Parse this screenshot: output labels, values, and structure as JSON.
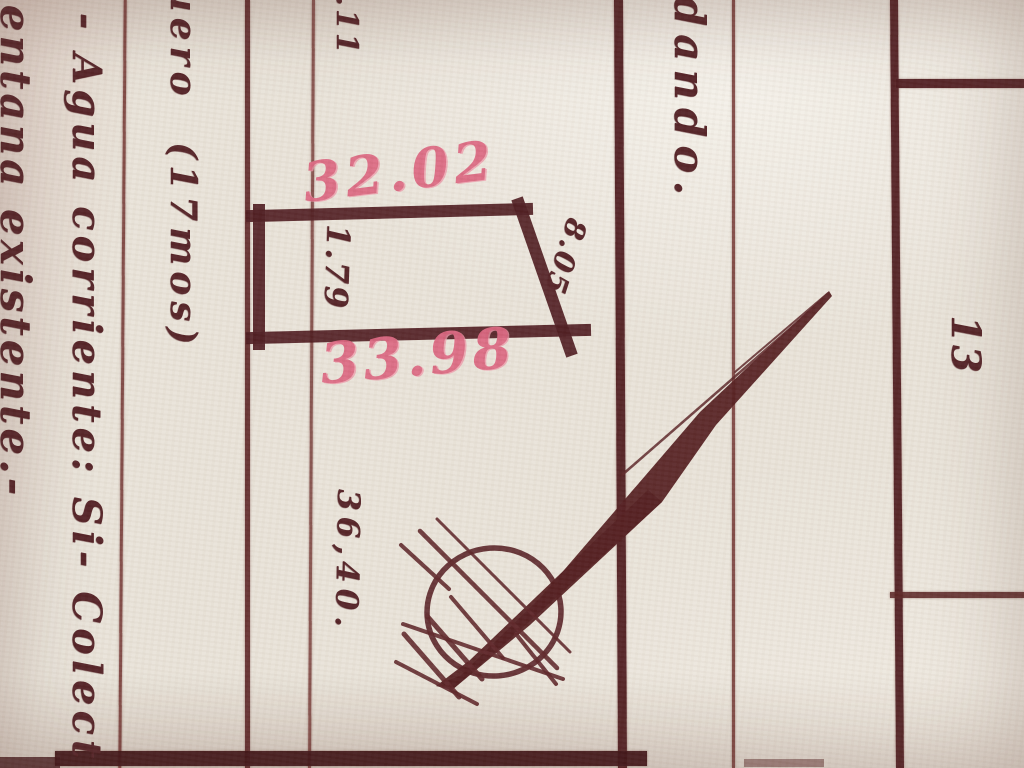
{
  "labels": {
    "top_fragment": ".11",
    "top_left_column": "uero (17mos)",
    "center_column": "dando.",
    "left_column_outer": "entana existente.-",
    "left_column_inner": "- Agua corriente: Si- Colect",
    "parcel_left_dim": "1.79",
    "parcel_right_dim": "8.05",
    "pink_top_dim": "32.02",
    "pink_bottom_dim": "33.98",
    "lower_dim": "36,40.",
    "lot_number": "13"
  },
  "colors": {
    "paper": "#e9e3d9",
    "ink_dark": "#54202a",
    "ink_line": "#6e332f",
    "pink_marker": "#dc6680"
  }
}
